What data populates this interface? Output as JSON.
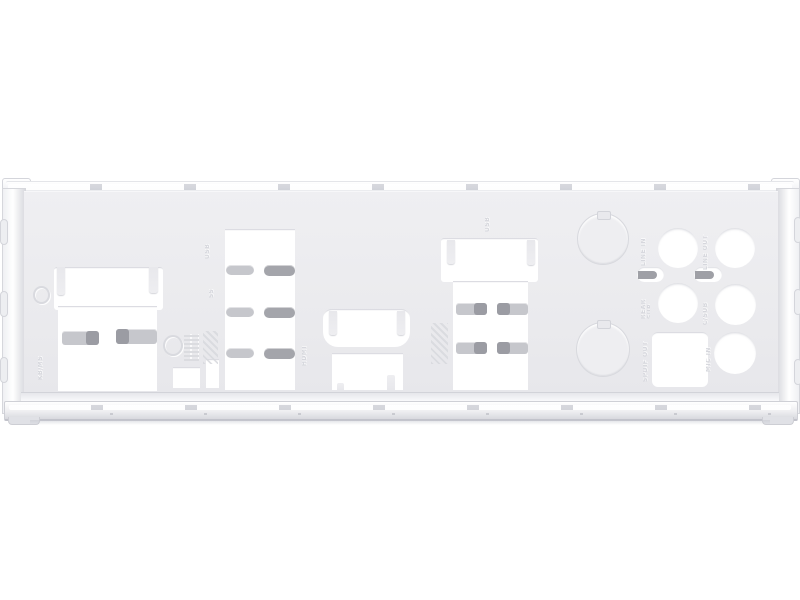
{
  "subject": {
    "description": "Product photo of a silver motherboard rear I/O shield blanking plate on a white background",
    "background_color": "#ffffff"
  },
  "colors": {
    "plate_face": "#ebebee",
    "cutout": "#ffffff",
    "spring_tab_light": "#c6c7cc",
    "spring_tab_dark": "#a4a5ab",
    "rail_highlight": "#ffffff",
    "rail_shadow": "#c7c8cf",
    "emboss": "#d6d7dd"
  },
  "cutouts": [
    {
      "id": "combo-port-left",
      "kind": "LAN/USB combo opening with retention tabs"
    },
    {
      "id": "usb-stack",
      "kind": "dual USB stack opening with spring fingers"
    },
    {
      "id": "hdmi-port",
      "kind": "HDMI opening"
    },
    {
      "id": "rect-port",
      "kind": "rectangular port opening"
    },
    {
      "id": "combo-port-right",
      "kind": "LAN/USB combo opening with retention tabs"
    },
    {
      "id": "knockout-blank",
      "kind": "two round punch-out blanks"
    },
    {
      "id": "audio-jacks",
      "kind": "five round audio jack holes plus square optical S/PDIF hole"
    },
    {
      "id": "small-cutouts",
      "kind": "two small rectangular openings"
    }
  ],
  "embossed_labels": {
    "left": "KB/MS",
    "usb_stack": "USB",
    "usb_stack_speed": "SS",
    "hdmi": "HDMI",
    "usb3_stack": "USB",
    "audio_jack_1": "LINE IN",
    "audio_jack_2": "LINE OUT",
    "audio_jack_3": "REAR SUR",
    "audio_jack_4": "C/SUB",
    "audio_spdif": "SPDIF OUT",
    "audio_jack_5": "MIC IN"
  }
}
